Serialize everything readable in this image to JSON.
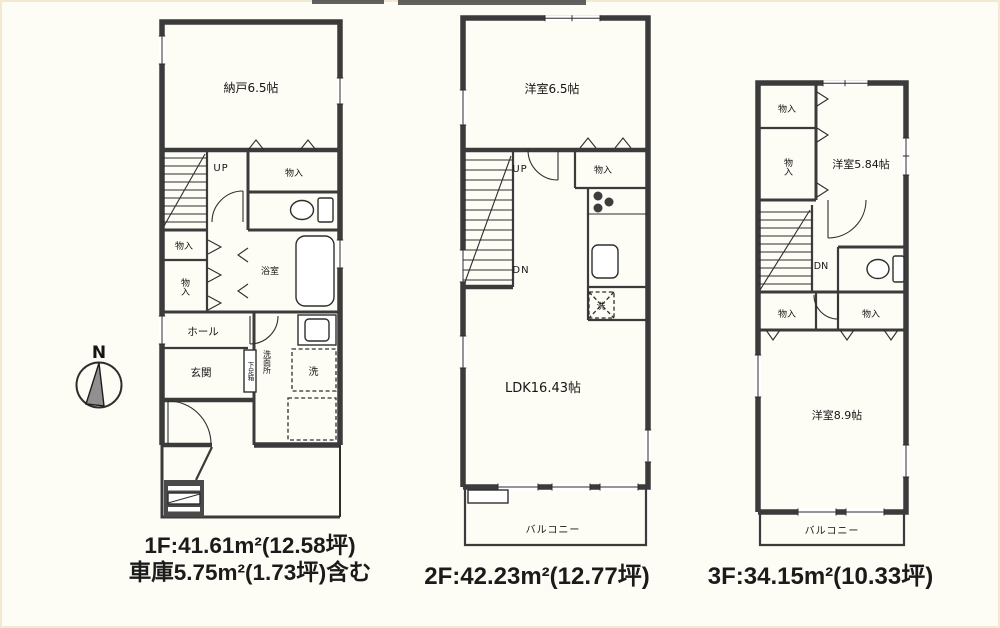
{
  "compass": {
    "north_label": "N"
  },
  "floor1": {
    "rooms": {
      "storage": "納戸6.5帖",
      "up": "UP",
      "closet_top_right": "物入",
      "closet_left_a": "物入",
      "closet_left_b": "物入",
      "bath": "浴室",
      "hall": "ホール",
      "entrance": "玄関",
      "shoe_box": "下足箱",
      "washroom": "洗面所",
      "washer": "洗"
    },
    "area_line1": "1F:41.61m²(12.58坪)",
    "area_line2": "車庫5.75m²(1.73坪)含む"
  },
  "floor2": {
    "rooms": {
      "bedroom": "洋室6.5帖",
      "up": "UP",
      "dn": "DN",
      "closet": "物入",
      "washer": "洗",
      "ldk": "LDK16.43帖",
      "balcony": "バルコニー"
    },
    "area_line1": "2F:42.23m²(12.77坪)"
  },
  "floor3": {
    "rooms": {
      "closet_top": "物入",
      "closet_mid": "物入",
      "bedroom_small": "洋室5.84帖",
      "dn": "DN",
      "closet_lower_left": "物入",
      "closet_lower_right": "物入",
      "bedroom_large": "洋室8.9帖",
      "balcony": "バルコニー"
    },
    "area_line1": "3F:34.15m²(10.33坪)"
  }
}
